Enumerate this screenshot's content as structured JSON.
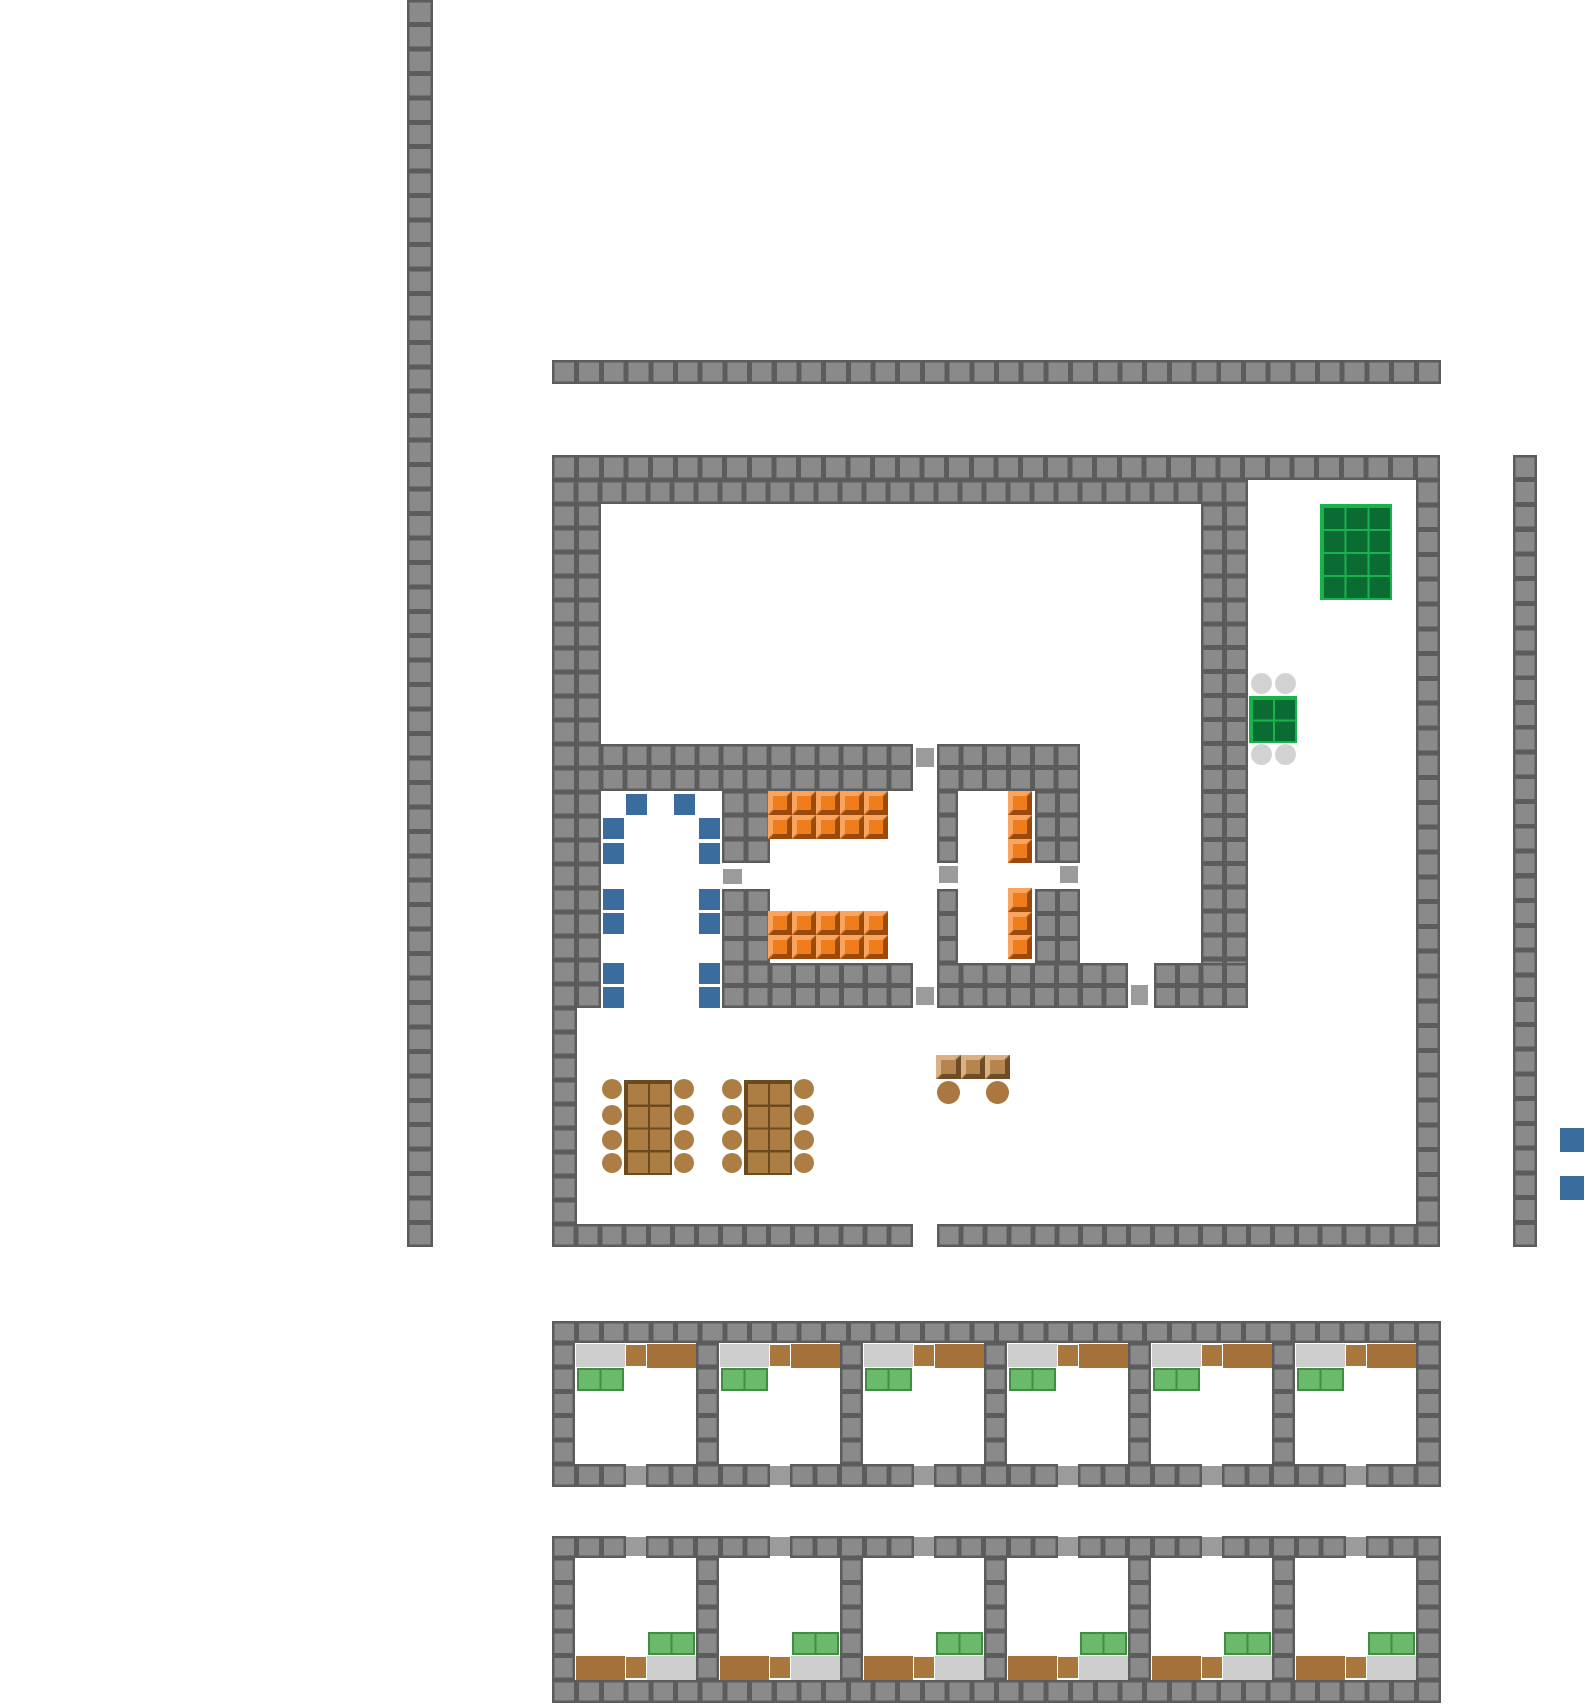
{
  "canvas": {
    "w": 1585,
    "h": 1705,
    "bg": "#ffffff"
  },
  "palette": {
    "wall_fill": "#8a8a8a",
    "wall_line": "#5c5c5c",
    "door": "#9b9b9b",
    "blue": "#3a6d9e",
    "orange_light": "#f9a55f",
    "orange_mid": "#f07d1b",
    "orange_dark": "#9a4a0a",
    "green_table_fill": "#0a6b33",
    "green_table_line": "#19b34c",
    "blanket_fill": "#6cb96c",
    "blanket_line": "#3f8f43",
    "bed_gray": "#cecece",
    "wood_fill": "#ad7e43",
    "wood_line": "#6b4a1e",
    "bench_light": "#d9b183",
    "bench_mid": "#b5854d",
    "bench_dark": "#6f4c28",
    "brown_small": "#a9763d",
    "brown_wide": "#a4713b",
    "chair_gray": "#d2d2d2",
    "stool_brown": "#a9773f"
  },
  "tile": {
    "size": 24.4,
    "edge": 2.5
  },
  "walls": [
    {
      "id": "west-long",
      "x": 407,
      "y": 0,
      "w": 26,
      "h": 1247
    },
    {
      "id": "north-strip",
      "x": 552,
      "y": 360,
      "w": 889,
      "h": 24
    },
    {
      "id": "bldg-top-r1",
      "x": 552,
      "y": 455,
      "w": 888,
      "h": 25
    },
    {
      "id": "bldg-top-r2",
      "x": 552,
      "y": 480,
      "w": 696,
      "h": 24
    },
    {
      "id": "bldg-west-a",
      "x": 552,
      "y": 504,
      "w": 49,
      "h": 504
    },
    {
      "id": "bldg-west-b",
      "x": 552,
      "y": 1008,
      "w": 25,
      "h": 216
    },
    {
      "id": "bldg-east",
      "x": 1416,
      "y": 480,
      "w": 24,
      "h": 744
    },
    {
      "id": "bldg-south-a",
      "x": 552,
      "y": 1224,
      "w": 361,
      "h": 23
    },
    {
      "id": "bldg-south-b",
      "x": 937,
      "y": 1224,
      "w": 503,
      "h": 23
    },
    {
      "id": "divider-east",
      "x": 1201,
      "y": 504,
      "w": 47,
      "h": 503
    },
    {
      "id": "mid-h-a",
      "x": 601,
      "y": 744,
      "w": 312,
      "h": 47
    },
    {
      "id": "mid-h-b",
      "x": 937,
      "y": 744,
      "w": 143,
      "h": 47
    },
    {
      "id": "v1-a",
      "x": 722,
      "y": 791,
      "w": 48,
      "h": 72
    },
    {
      "id": "v1-b",
      "x": 722,
      "y": 889,
      "w": 48,
      "h": 74
    },
    {
      "id": "v2-a",
      "x": 937,
      "y": 791,
      "w": 21,
      "h": 72
    },
    {
      "id": "v2-b",
      "x": 937,
      "y": 889,
      "w": 21,
      "h": 74
    },
    {
      "id": "v3-a",
      "x": 1035,
      "y": 791,
      "w": 45,
      "h": 72
    },
    {
      "id": "v3-b",
      "x": 1035,
      "y": 889,
      "w": 45,
      "h": 74
    },
    {
      "id": "rooms-south-a",
      "x": 722,
      "y": 963,
      "w": 191,
      "h": 45
    },
    {
      "id": "rooms-south-b",
      "x": 937,
      "y": 963,
      "w": 191,
      "h": 45
    },
    {
      "id": "rooms-south-c",
      "x": 1154,
      "y": 963,
      "w": 94,
      "h": 45
    },
    {
      "id": "east-long",
      "x": 1513,
      "y": 455,
      "w": 24,
      "h": 792
    },
    {
      "id": "b1-top",
      "x": 552,
      "y": 1321,
      "w": 889,
      "h": 22
    },
    {
      "id": "b1-west",
      "x": 552,
      "y": 1343,
      "w": 23,
      "h": 121
    },
    {
      "id": "b1-east",
      "x": 1416,
      "y": 1343,
      "w": 25,
      "h": 121
    },
    {
      "id": "b1-div1",
      "x": 696,
      "y": 1343,
      "w": 23,
      "h": 121
    },
    {
      "id": "b1-div2",
      "x": 840,
      "y": 1343,
      "w": 23,
      "h": 121
    },
    {
      "id": "b1-div3",
      "x": 984,
      "y": 1343,
      "w": 23,
      "h": 121
    },
    {
      "id": "b1-div4",
      "x": 1128,
      "y": 1343,
      "w": 23,
      "h": 121
    },
    {
      "id": "b1-div5",
      "x": 1272,
      "y": 1343,
      "w": 23,
      "h": 121
    },
    {
      "id": "b1-bot1",
      "x": 552,
      "y": 1464,
      "w": 74,
      "h": 23
    },
    {
      "id": "b1-bot2",
      "x": 646,
      "y": 1464,
      "w": 124,
      "h": 23
    },
    {
      "id": "b1-bot3",
      "x": 790,
      "y": 1464,
      "w": 124,
      "h": 23
    },
    {
      "id": "b1-bot4",
      "x": 934,
      "y": 1464,
      "w": 124,
      "h": 23
    },
    {
      "id": "b1-bot5",
      "x": 1078,
      "y": 1464,
      "w": 124,
      "h": 23
    },
    {
      "id": "b1-bot6",
      "x": 1222,
      "y": 1464,
      "w": 124,
      "h": 23
    },
    {
      "id": "b1-bot7",
      "x": 1366,
      "y": 1464,
      "w": 75,
      "h": 23
    },
    {
      "id": "b2-top1",
      "x": 552,
      "y": 1536,
      "w": 74,
      "h": 22
    },
    {
      "id": "b2-top2",
      "x": 646,
      "y": 1536,
      "w": 124,
      "h": 22
    },
    {
      "id": "b2-top3",
      "x": 790,
      "y": 1536,
      "w": 124,
      "h": 22
    },
    {
      "id": "b2-top4",
      "x": 934,
      "y": 1536,
      "w": 124,
      "h": 22
    },
    {
      "id": "b2-top5",
      "x": 1078,
      "y": 1536,
      "w": 124,
      "h": 22
    },
    {
      "id": "b2-top6",
      "x": 1222,
      "y": 1536,
      "w": 124,
      "h": 22
    },
    {
      "id": "b2-top7",
      "x": 1366,
      "y": 1536,
      "w": 75,
      "h": 22
    },
    {
      "id": "b2-west",
      "x": 552,
      "y": 1558,
      "w": 23,
      "h": 122
    },
    {
      "id": "b2-east",
      "x": 1416,
      "y": 1558,
      "w": 25,
      "h": 122
    },
    {
      "id": "b2-div1",
      "x": 696,
      "y": 1558,
      "w": 23,
      "h": 122
    },
    {
      "id": "b2-div2",
      "x": 840,
      "y": 1558,
      "w": 23,
      "h": 122
    },
    {
      "id": "b2-div3",
      "x": 984,
      "y": 1558,
      "w": 23,
      "h": 122
    },
    {
      "id": "b2-div4",
      "x": 1128,
      "y": 1558,
      "w": 23,
      "h": 122
    },
    {
      "id": "b2-div5",
      "x": 1272,
      "y": 1558,
      "w": 23,
      "h": 122
    },
    {
      "id": "b2-bot",
      "x": 552,
      "y": 1680,
      "w": 889,
      "h": 23
    }
  ],
  "doors": [
    {
      "x": 916,
      "y": 748,
      "w": 18,
      "h": 19
    },
    {
      "x": 723,
      "y": 869,
      "w": 19,
      "h": 15
    },
    {
      "x": 939,
      "y": 866,
      "w": 19,
      "h": 17
    },
    {
      "x": 1060,
      "y": 866,
      "w": 18,
      "h": 17
    },
    {
      "x": 916,
      "y": 987,
      "w": 18,
      "h": 18
    },
    {
      "x": 1131,
      "y": 985,
      "w": 17,
      "h": 20
    },
    {
      "x": 626,
      "y": 1466,
      "w": 20,
      "h": 19
    },
    {
      "x": 770,
      "y": 1466,
      "w": 20,
      "h": 19
    },
    {
      "x": 914,
      "y": 1466,
      "w": 20,
      "h": 19
    },
    {
      "x": 1058,
      "y": 1466,
      "w": 20,
      "h": 19
    },
    {
      "x": 1202,
      "y": 1466,
      "w": 20,
      "h": 19
    },
    {
      "x": 1346,
      "y": 1466,
      "w": 20,
      "h": 19
    },
    {
      "x": 626,
      "y": 1537,
      "w": 20,
      "h": 19
    },
    {
      "x": 770,
      "y": 1537,
      "w": 20,
      "h": 19
    },
    {
      "x": 914,
      "y": 1537,
      "w": 20,
      "h": 19
    },
    {
      "x": 1058,
      "y": 1537,
      "w": 20,
      "h": 19
    },
    {
      "x": 1202,
      "y": 1537,
      "w": 20,
      "h": 19
    },
    {
      "x": 1346,
      "y": 1537,
      "w": 20,
      "h": 19
    }
  ],
  "furniture": {
    "green_tables": [
      {
        "id": "table-green-large",
        "x": 1320,
        "y": 504,
        "w": 72,
        "h": 96,
        "cols": 3,
        "rows": 4
      },
      {
        "id": "table-green-small",
        "x": 1249,
        "y": 696,
        "w": 48,
        "h": 47,
        "cols": 2,
        "rows": 2
      }
    ],
    "gray_chairs": {
      "size": 21,
      "positions": [
        [
          1251,
          673
        ],
        [
          1275,
          673
        ],
        [
          1251,
          744
        ],
        [
          1275,
          744
        ]
      ]
    },
    "blue_chairs": {
      "size": 21,
      "positions": [
        [
          626,
          794
        ],
        [
          674,
          794
        ],
        [
          603,
          818
        ],
        [
          699,
          818
        ],
        [
          603,
          843
        ],
        [
          699,
          843
        ],
        [
          603,
          889
        ],
        [
          699,
          889
        ],
        [
          603,
          913
        ],
        [
          699,
          913
        ],
        [
          603,
          963
        ],
        [
          699,
          963
        ],
        [
          603,
          987
        ],
        [
          699,
          987
        ]
      ]
    },
    "orange_blocks": [
      {
        "x": 768,
        "y": 791,
        "w": 120,
        "h": 48,
        "cols": 5,
        "rows": 2
      },
      {
        "x": 768,
        "y": 911,
        "w": 120,
        "h": 48,
        "cols": 5,
        "rows": 2
      },
      {
        "x": 1008,
        "y": 791,
        "w": 24,
        "h": 72,
        "cols": 1,
        "rows": 3
      },
      {
        "x": 1008,
        "y": 888,
        "w": 24,
        "h": 71,
        "cols": 1,
        "rows": 3
      }
    ],
    "wood_tables": [
      {
        "x": 624,
        "y": 1080,
        "w": 48,
        "h": 95,
        "cols": 2,
        "rows": 4
      },
      {
        "x": 744,
        "y": 1080,
        "w": 48,
        "h": 95,
        "cols": 2,
        "rows": 4
      }
    ],
    "wood_chairs": {
      "size": 20,
      "positions": [
        [
          602,
          1079
        ],
        [
          674,
          1079
        ],
        [
          602,
          1105
        ],
        [
          674,
          1105
        ],
        [
          602,
          1130
        ],
        [
          674,
          1130
        ],
        [
          602,
          1153
        ],
        [
          674,
          1153
        ],
        [
          722,
          1079
        ],
        [
          794,
          1079
        ],
        [
          722,
          1105
        ],
        [
          794,
          1105
        ],
        [
          722,
          1130
        ],
        [
          794,
          1130
        ],
        [
          722,
          1153
        ],
        [
          794,
          1153
        ]
      ]
    },
    "counter": {
      "x": 936,
      "y": 1055,
      "w": 74,
      "h": 24,
      "cols": 3,
      "rows": 1
    },
    "stools": {
      "size": 23,
      "positions": [
        [
          937,
          1081
        ],
        [
          986,
          1081
        ]
      ]
    },
    "blue_markers": {
      "size": 24,
      "positions": [
        [
          1560,
          1128
        ],
        [
          1560,
          1176
        ]
      ]
    }
  },
  "cell_blocks": [
    {
      "id": "band1",
      "cell_x": [
        576,
        720,
        864,
        1008,
        1152,
        1296
      ],
      "items": [
        {
          "type": "bed-gray",
          "dx": 0,
          "y": 1344,
          "w": 49,
          "h": 23
        },
        {
          "type": "bed-green",
          "dx": 1,
          "y": 1368,
          "w": 47,
          "h": 23
        },
        {
          "type": "brown-small",
          "dx": 50,
          "y": 1345,
          "w": 20,
          "h": 21
        },
        {
          "type": "brown-wide",
          "dx": 71,
          "y": 1344,
          "w": 49,
          "h": 24
        }
      ]
    },
    {
      "id": "band2",
      "cell_x": [
        576,
        720,
        864,
        1008,
        1152,
        1296
      ],
      "items": [
        {
          "type": "brown-wide",
          "dx": 0,
          "y": 1656,
          "w": 49,
          "h": 24
        },
        {
          "type": "brown-small",
          "dx": 50,
          "y": 1657,
          "w": 20,
          "h": 21
        },
        {
          "type": "bed-gray",
          "dx": 71,
          "y": 1656,
          "w": 49,
          "h": 24
        },
        {
          "type": "bed-green",
          "dx": 72,
          "y": 1632,
          "w": 47,
          "h": 23
        }
      ]
    }
  ]
}
